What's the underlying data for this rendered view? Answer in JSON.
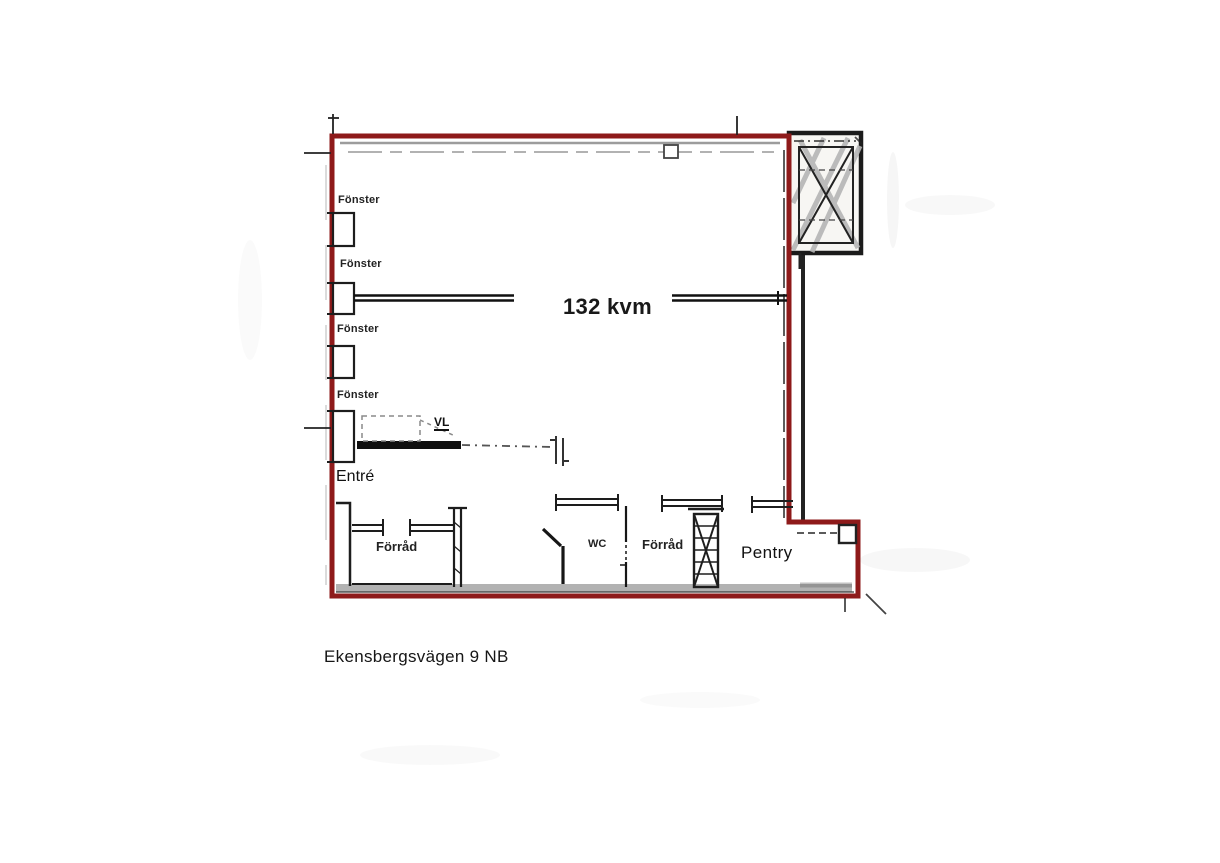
{
  "floorplan": {
    "address": "Ekensbergsvägen 9 NB",
    "area_label": "132 kvm",
    "entrance_label": "Entré",
    "vent_label": "VL",
    "window_labels": [
      "Fönster",
      "Fönster",
      "Fönster",
      "Fönster"
    ],
    "rooms": {
      "storage1": "Förråd",
      "wc": "WC",
      "storage2": "Förråd",
      "pantry": "Pentry"
    },
    "colors": {
      "boundary_red": "#8e1a1a",
      "wall_black": "#1d1d1d",
      "hatch_gray": "#b5b5b5"
    }
  }
}
